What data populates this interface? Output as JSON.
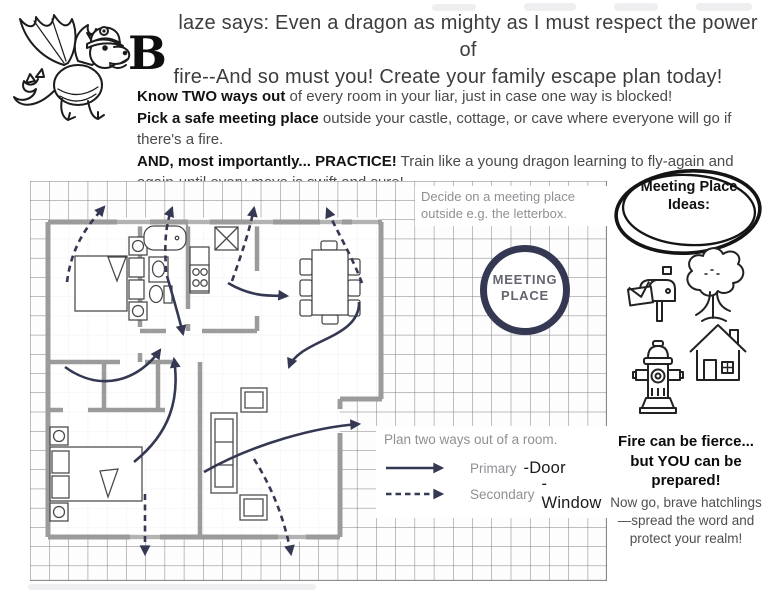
{
  "header": {
    "initial": "B",
    "line1": "laze says:  Even a dragon as mighty as I must respect the power of",
    "line2": "fire--And so must you!  Create your family escape plan today!"
  },
  "instructions": [
    {
      "bold": "Know TWO ways out",
      "rest": " of every room in your liar, just in case one way is blocked!"
    },
    {
      "bold": "Pick a safe meeting place",
      "rest": " outside your castle, cottage, or cave where everyone will go if there's a fire."
    },
    {
      "bold": "AND, most importantly... PRACTICE!",
      "rest": " Train like a young dragon learning to fly-again and again-until every move is swift and sure!"
    }
  ],
  "floor_plan": {
    "note_line1": "Decide on a meeting place",
    "note_line2": "outside e.g. the letterbox.",
    "meeting_circle_line1": "MEETING",
    "meeting_circle_line2": "PLACE",
    "legend": {
      "title": "Plan two ways out of a room.",
      "primary_label": "Primary",
      "primary_target": "-Door",
      "secondary_label": "Secondary",
      "secondary_target": "-Window"
    }
  },
  "sidebar": {
    "ideas_title": "Meeting Place Ideas:",
    "icons": [
      {
        "name": "mailbox-icon"
      },
      {
        "name": "tree-icon"
      },
      {
        "name": "fire-hydrant-icon"
      },
      {
        "name": "house-icon"
      }
    ],
    "closing_bold": "Fire can be fierce... but YOU can be prepared!",
    "closing_text": "Now go, brave hatchlings—spread the word and protect your realm!"
  },
  "colors": {
    "arrow_navy": "#343852",
    "wall_gray": "#9b9b9b",
    "label_gray": "#8f9094",
    "ink": "#1a1a1a"
  }
}
